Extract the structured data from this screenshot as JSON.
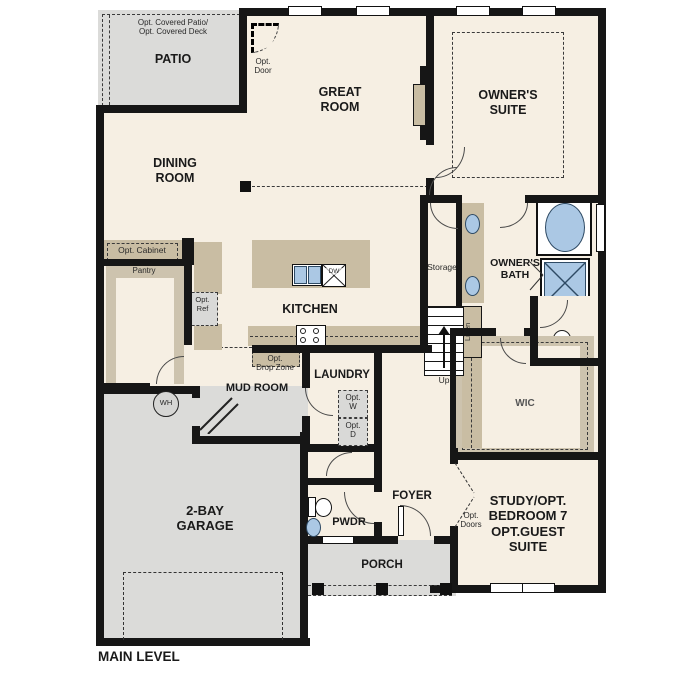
{
  "plan_title": "MAIN LEVEL",
  "colors": {
    "floor": "#f6efe3",
    "outdoor": "#dbdbd9",
    "cabinet": "#c9bda3",
    "fixture_blue": "#abc8e4",
    "wall": "#161616"
  },
  "rooms": {
    "patio": {
      "name": "PATIO",
      "note": "Opt. Covered Patio/\nOpt. Covered Deck"
    },
    "great_room": {
      "name": "GREAT\nROOM"
    },
    "owners_suite": {
      "name": "OWNER'S\nSUITE"
    },
    "dining_room": {
      "name": "DINING\nROOM"
    },
    "kitchen": {
      "name": "KITCHEN"
    },
    "owners_bath": {
      "name": "OWNER'S\nBATH"
    },
    "mud_room": {
      "name": "MUD ROOM"
    },
    "laundry": {
      "name": "LAUNDRY"
    },
    "wic": {
      "name": "WIC"
    },
    "garage": {
      "name": "2-BAY\nGARAGE"
    },
    "pwdr": {
      "name": "PWDR"
    },
    "foyer": {
      "name": "FOYER"
    },
    "study": {
      "name": "STUDY/OPT.\nBEDROOM 7\nOPT.GUEST\nSUITE"
    },
    "porch": {
      "name": "PORCH"
    },
    "pantry": {
      "name": "Pantry"
    },
    "storage": {
      "name": "Storage"
    },
    "linen": {
      "name": "Linen"
    }
  },
  "annotations": {
    "opt_door": "Opt.\nDoor",
    "opt_cabinet": "Opt. Cabinet",
    "opt_ref": "Opt.\nRef",
    "opt_drop_zone": "Opt.\nDrop Zone",
    "opt_w": "Opt.\nW",
    "opt_d": "Opt.\nD",
    "opt_doors": "Opt.\nDoors",
    "up": "Up",
    "dw": "DW",
    "wh": "WH"
  }
}
